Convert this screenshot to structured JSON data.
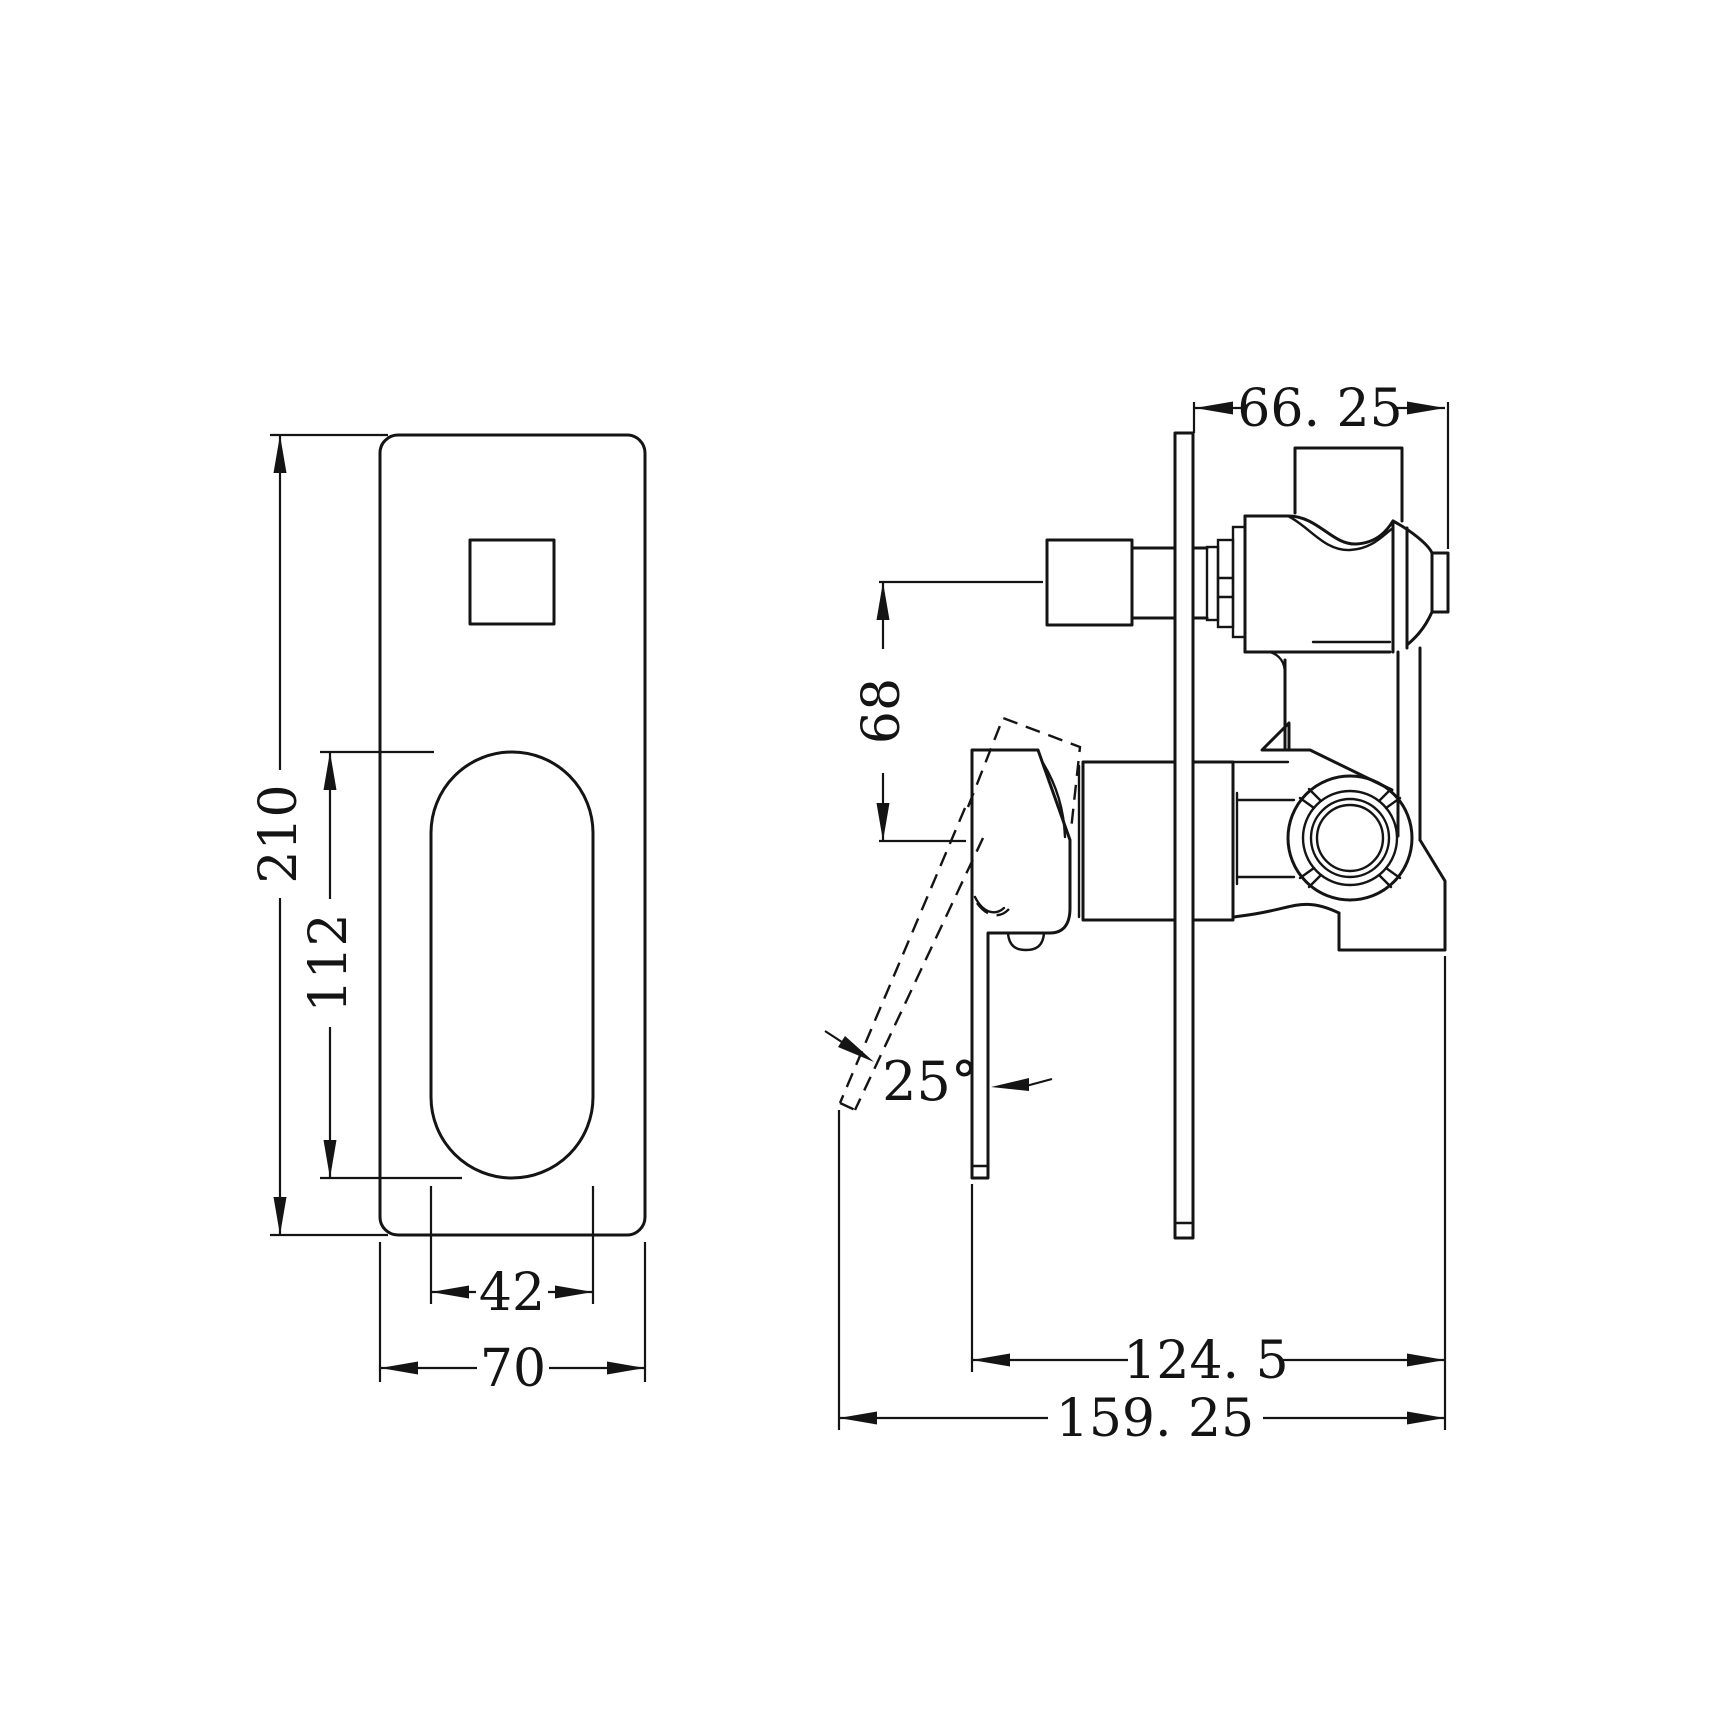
{
  "page": {
    "background": "#ffffff",
    "ink": "#141414",
    "description": "CAD dimension drawing of a wall-mixer shower valve with diverter: front view of trim plate and side view of rough-in body"
  },
  "front_view": {
    "name": "front view – trim plate",
    "dims": {
      "plate_height": "210",
      "slot_height": "112",
      "slot_width": "42",
      "plate_width": "70"
    }
  },
  "side_view": {
    "name": "side view – valve body",
    "dims": {
      "outlet_depth": "66. 25",
      "outlet_to_axis": "68",
      "lever_angle": "25°",
      "lever_depth": "124. 5",
      "overall_depth": "159. 25"
    }
  }
}
